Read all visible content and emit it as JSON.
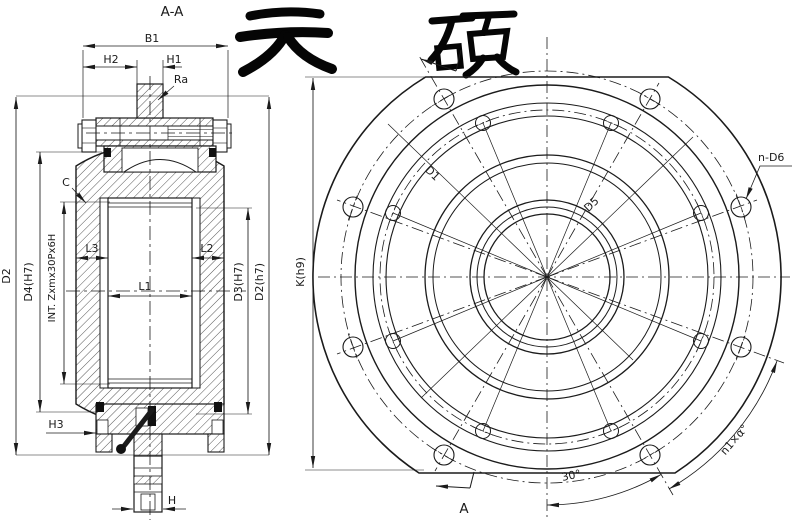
{
  "logo": {
    "text": "天硕"
  },
  "section_view": {
    "title": "A-A",
    "dims": {
      "b1": "B1",
      "h2": "H2",
      "h1": "H1",
      "ra": "Ra",
      "c": "C",
      "d2": "D2",
      "d4": "D4(H7)",
      "thread": "INT. Zxmx30Px6H",
      "l3": "L3",
      "l1": "L1",
      "l2": "L2",
      "d3": "D3(H7)",
      "d2r": "D2(h7)",
      "h3": "H3",
      "h": "H"
    }
  },
  "front_view": {
    "dims": {
      "k": "K(h9)",
      "d1": "D1",
      "d5": "D5",
      "n_d6": "n-D6",
      "spacing": "n1×α°",
      "angle": "30°",
      "section": "A"
    },
    "outer_hole_count": 8,
    "inner_hole_count": 8
  },
  "colors": {
    "line": "#1b1b1b",
    "background": "#ffffff"
  }
}
